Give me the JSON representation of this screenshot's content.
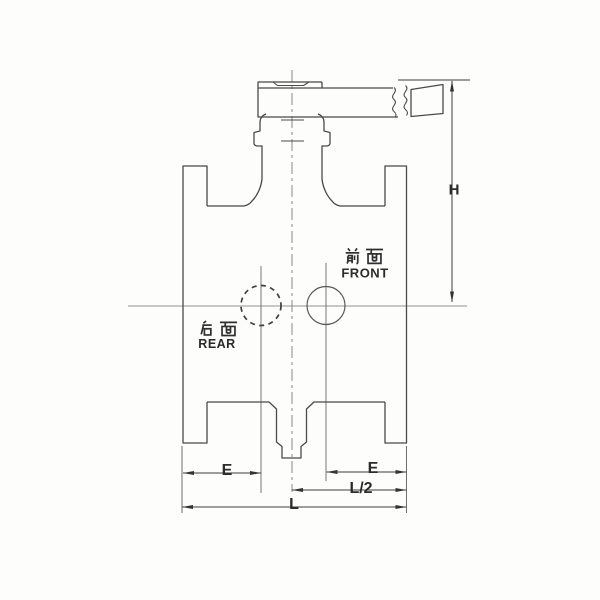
{
  "labels": {
    "front_cn": "前面",
    "front_en": "FRONT",
    "rear_cn": "后面",
    "rear_en": "REAR",
    "dim_h": "H",
    "dim_e_left": "E",
    "dim_e_right": "E",
    "dim_l_half": "L/2",
    "dim_l": "L"
  },
  "colors": {
    "line": "#4a4a4a",
    "thin_line": "#5f5f5f",
    "centerline": "#929292",
    "dimension": "#3d3d3d",
    "text": "#2b2b2b",
    "background": "#fdfdfc"
  }
}
